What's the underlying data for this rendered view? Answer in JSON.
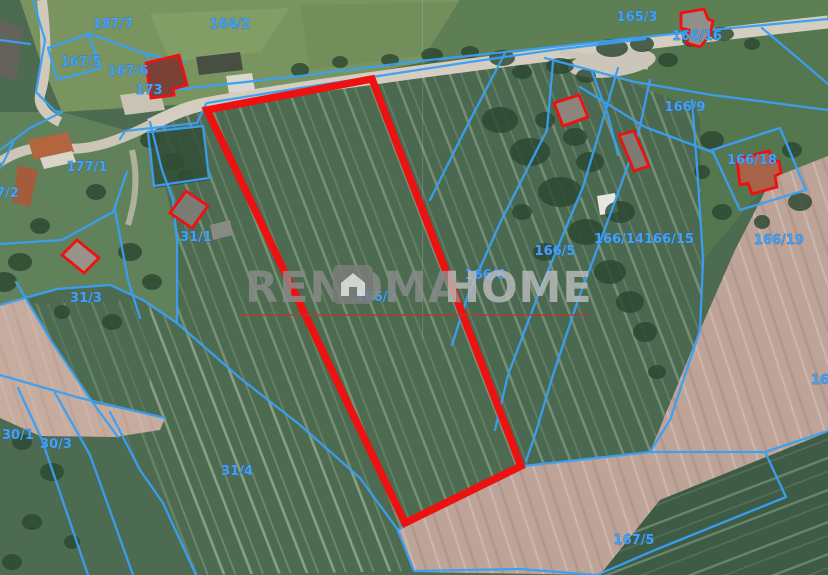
{
  "app": {
    "type": "cadastral-aerial-map-view"
  },
  "watermark": {
    "brand_primary": "RENOMA",
    "brand_secondary": "HOME"
  },
  "highlighted_parcel": {
    "id": "166/7",
    "outline_color": "#ee1111"
  },
  "labels": {
    "l187_7": "187/7",
    "l164_2": "164/2",
    "l165_3": "165/3",
    "l166_16": "166/16",
    "l167_5a": "167/5",
    "l167_6": "167/6",
    "l173": "173",
    "l166_9": "166/9",
    "l177_1": "177/1",
    "l7_2": "7/2",
    "l31_1": "31/1",
    "l31_3": "31/3",
    "l166_5": "166/5",
    "l166_14": "166/14",
    "l166_15": "166/15",
    "l166_19": "166/19",
    "l166_18": "166/18",
    "l166_6": "166/6",
    "l166_7": "166/7",
    "l30_1": "30/1",
    "l30_3": "30/3",
    "l31_4": "31/4",
    "l167_5b": "167/5",
    "l16_edge": "16"
  },
  "building_markers": [
    "near-parcel-173",
    "parcel-166-16",
    "near-parcel-165-3",
    "parcel-166-14-barn",
    "parcel-166-18",
    "parcel-31-1",
    "parcel-31-3"
  ],
  "colors": {
    "cadastral_line": "#3aa0f5",
    "parcel_label": "#47a0f2",
    "highlight_red": "#ee1111",
    "watermark_dark": "#8b8b8b",
    "watermark_light": "#bbbbbb",
    "watermark_underline": "#b23b33"
  }
}
